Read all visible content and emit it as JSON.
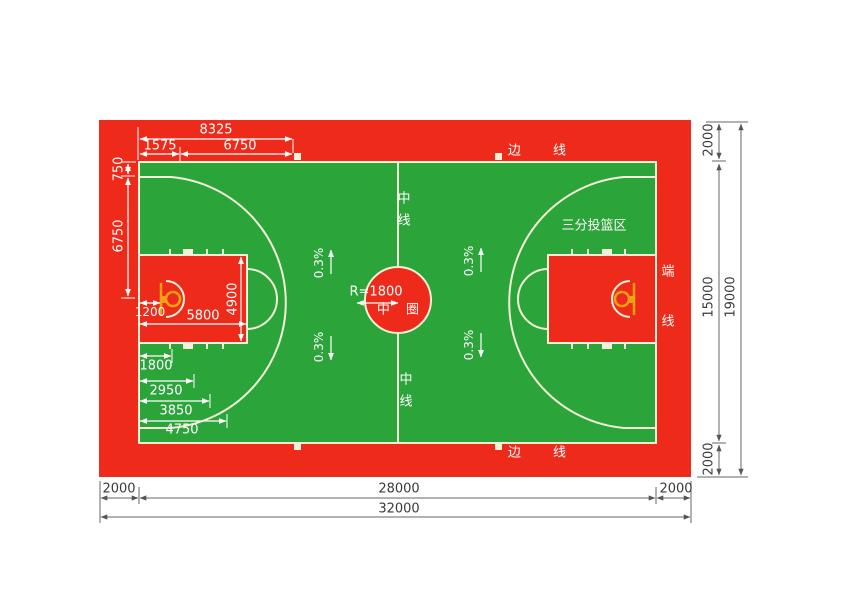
{
  "court": {
    "label_sideline": "边 线",
    "label_endline_char1": "端",
    "label_endline_char2": "线",
    "label_centerline_char1": "中",
    "label_centerline_char2": "线",
    "label_center_circle": "中 圈",
    "label_center_radius": "R=1800",
    "label_three_point_area": "三分投篮区",
    "label_slope": "0.3%"
  },
  "dimensions": {
    "top": {
      "endline_to_arc": "8325",
      "endline_to_basket": "1575",
      "arc_radius": "6750"
    },
    "left": {
      "sideline_to_3pt": "750",
      "sideline_to_basket_axis": "6750"
    },
    "key": {
      "backboard_offset": "1200",
      "key_length": "5800",
      "key_width": "4900"
    },
    "lane_marks": {
      "m1": "1800",
      "m2": "2950",
      "m3": "3850",
      "m4": "4750"
    },
    "bottom": {
      "apron_left": "2000",
      "court_length": "28000",
      "apron_right": "2000",
      "total_length": "32000"
    },
    "right": {
      "apron_top": "2000",
      "court_width": "15000",
      "apron_bottom": "2000",
      "total_width": "19000"
    }
  },
  "colors": {
    "apron_red": "#ee2b1a",
    "court_green": "#2ba43a",
    "court_line_cream": "#f3f2d8",
    "hoop_orange": "#f0a213",
    "annotation_white": "#ffffff",
    "dimension_dark": "#555555"
  }
}
